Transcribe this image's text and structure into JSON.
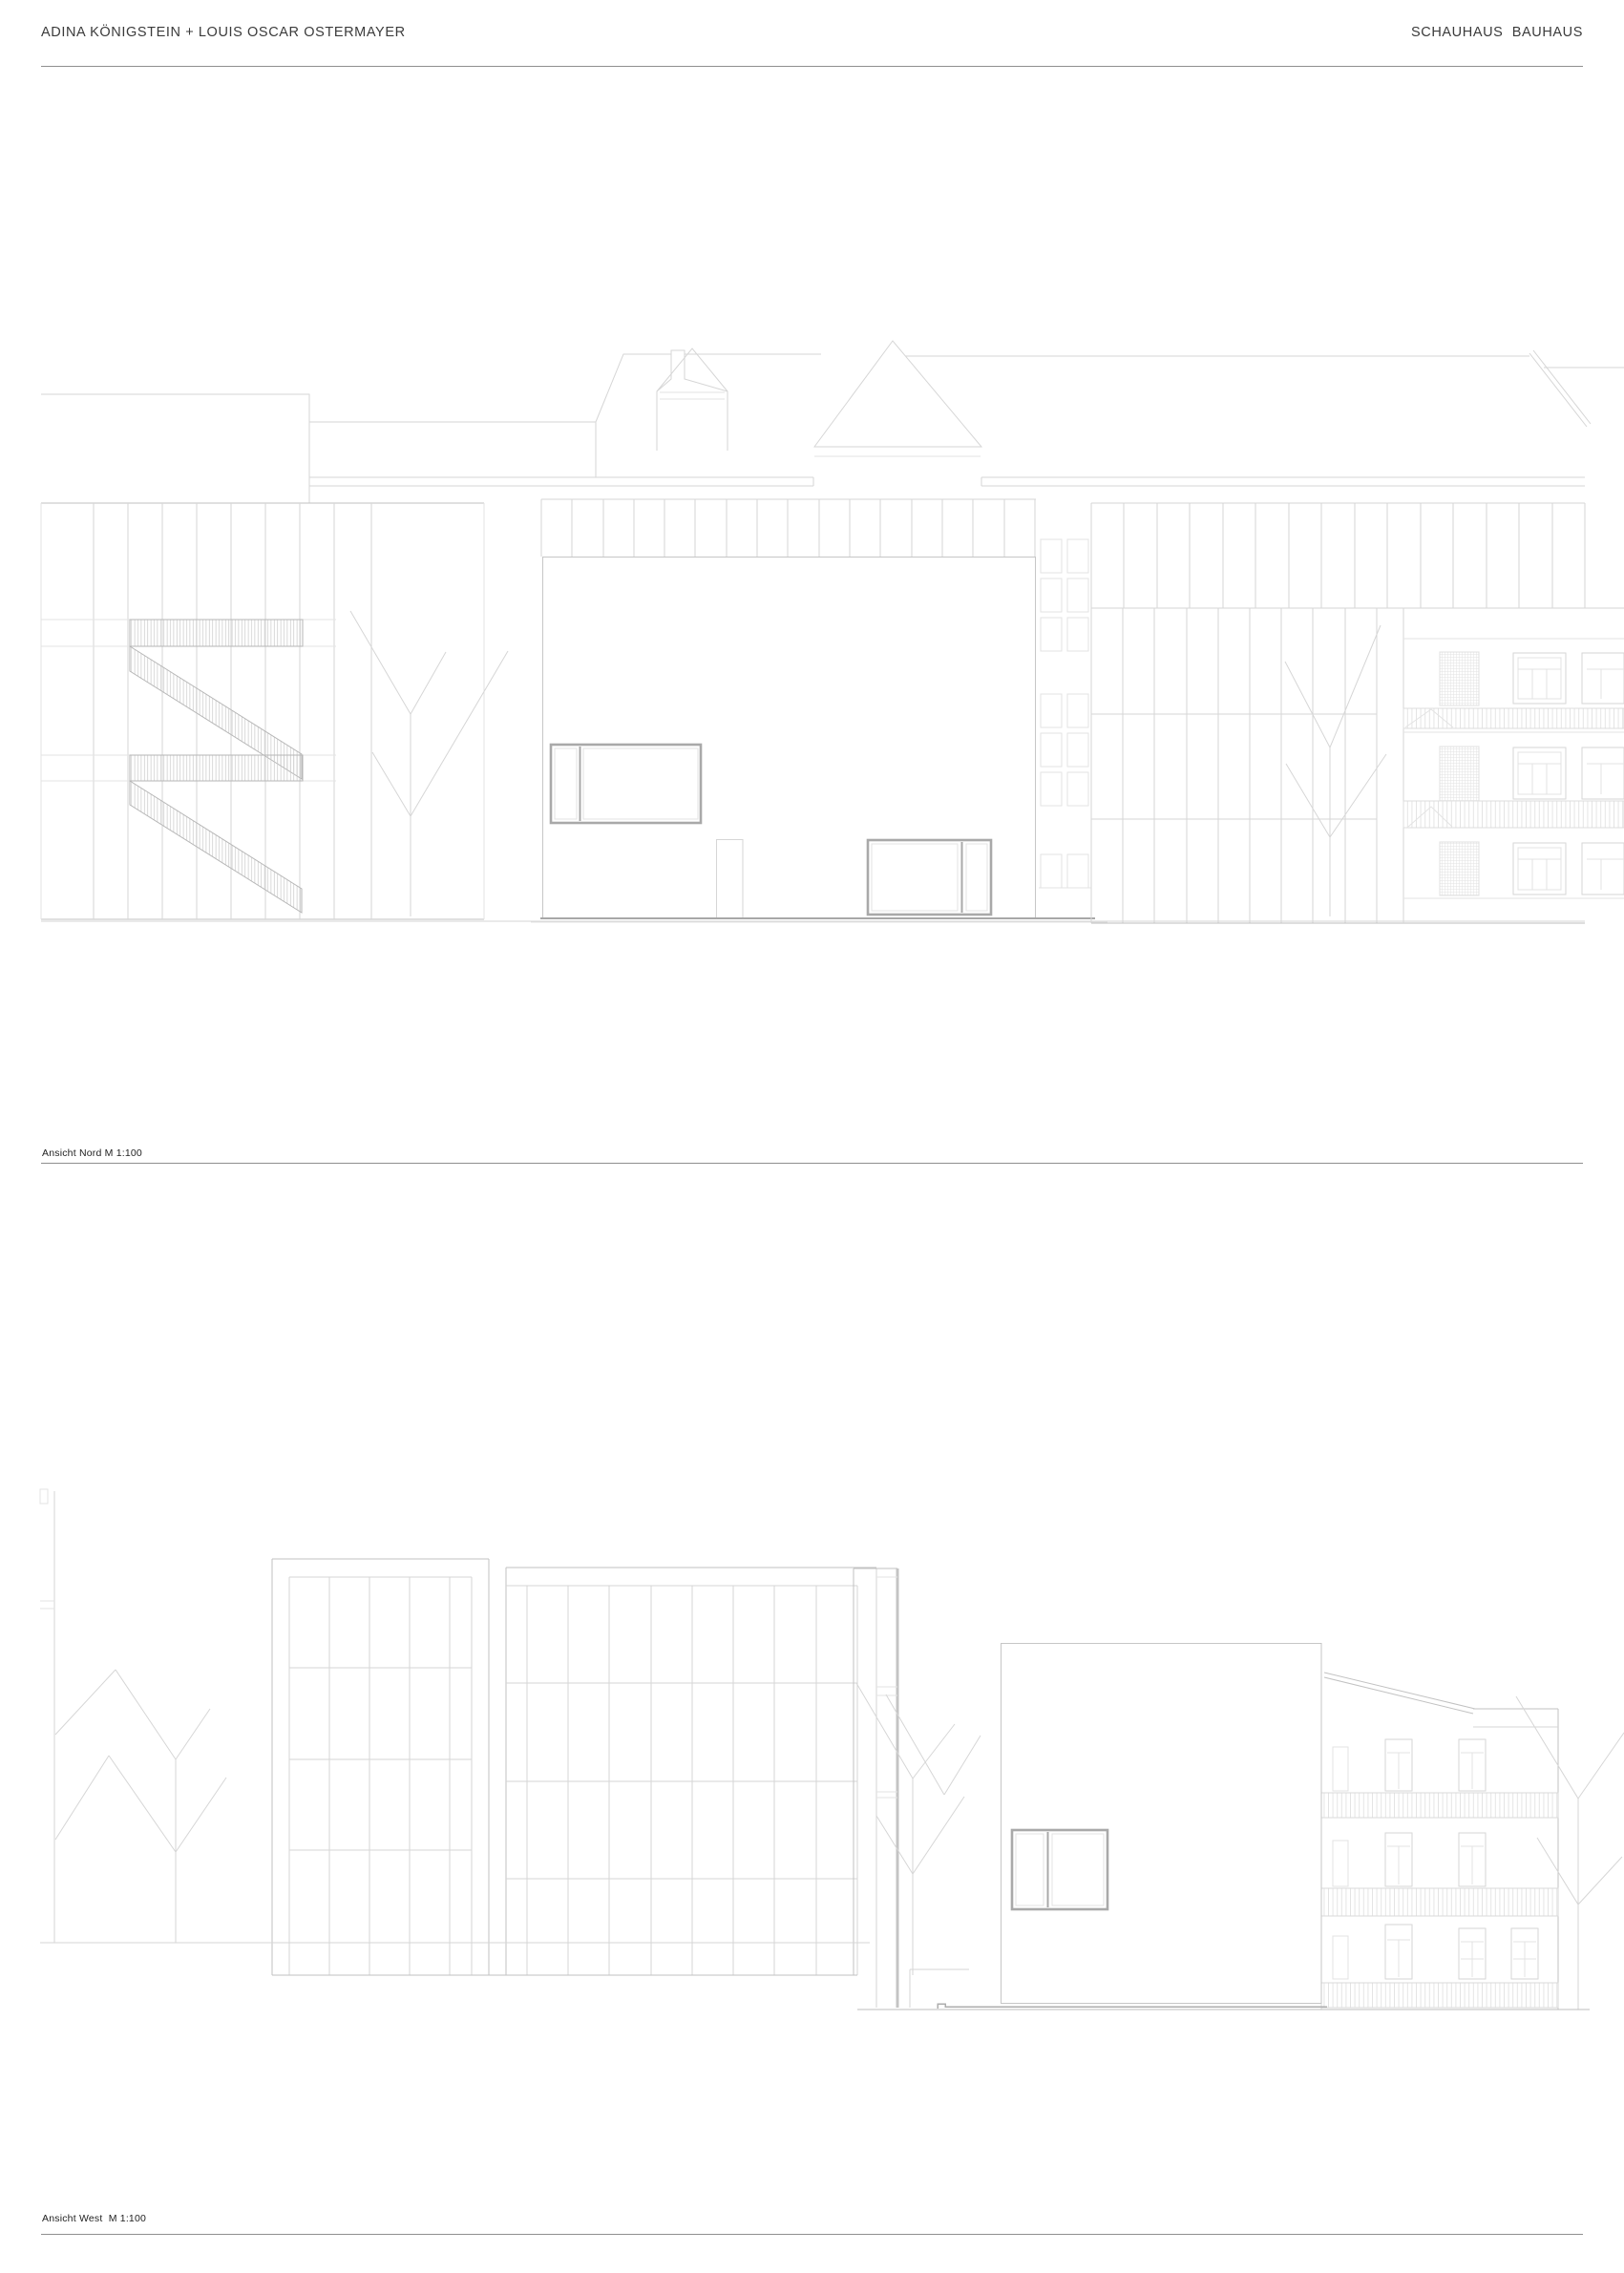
{
  "header": {
    "left_title": "ADINA KÖNIGSTEIN + LOUIS OSCAR OSTERMAYER",
    "right_title": "SCHAUHAUS  BAUHAUS"
  },
  "labels": {
    "north": "Ansicht Nord M 1:100",
    "west": "Ansicht West  M 1:100"
  },
  "drawings": {
    "north_name": "North elevation, scale 1:100",
    "west_name": "West elevation, scale 1:100"
  },
  "colors": {
    "background": "#ffffff",
    "text": "#3b3b3b",
    "rule": "#8f8f8f",
    "line_faint": "#e3e3e3",
    "line_light": "#d6d6d6",
    "line_medium": "#c2c2c2",
    "line_dark": "#a9a9a9",
    "hatch": "#c9c9c9"
  }
}
